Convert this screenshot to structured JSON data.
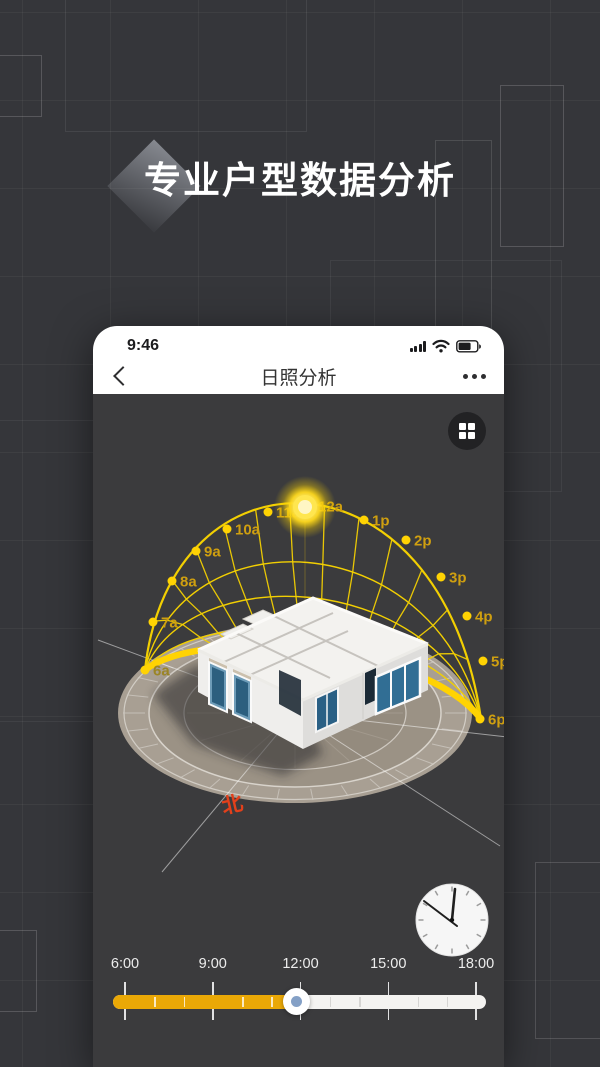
{
  "hero": {
    "title": "专业户型数据分析"
  },
  "phone": {
    "status_bar": {
      "time": "9:46",
      "icons": [
        "signal-bars",
        "wifi",
        "battery"
      ]
    },
    "nav": {
      "title": "日照分析"
    }
  },
  "viewer": {
    "north_label": "北"
  },
  "chart_data": {
    "type": "sun-path-dome",
    "title": "日照分析 sun path over 3D house model",
    "hour_markers": [
      {
        "label": "6a",
        "x": 52,
        "y": 276
      },
      {
        "label": "7a",
        "x": 60,
        "y": 228
      },
      {
        "label": "8a",
        "x": 79,
        "y": 187
      },
      {
        "label": "9a",
        "x": 103,
        "y": 157
      },
      {
        "label": "10a",
        "x": 134,
        "y": 135
      },
      {
        "label": "11a",
        "x": 175,
        "y": 118
      },
      {
        "label": "12a",
        "x": 215,
        "y": 112
      },
      {
        "label": "1p",
        "x": 271,
        "y": 126
      },
      {
        "label": "2p",
        "x": 313,
        "y": 146
      },
      {
        "label": "3p",
        "x": 348,
        "y": 183
      },
      {
        "label": "4p",
        "x": 374,
        "y": 222
      },
      {
        "label": "5p",
        "x": 390,
        "y": 267
      },
      {
        "label": "6p",
        "x": 387,
        "y": 325
      }
    ],
    "sun": {
      "x": 212,
      "y": 113
    }
  },
  "slider": {
    "tick_labels": [
      "6:00",
      "9:00",
      "12:00",
      "15:00",
      "18:00"
    ],
    "selected_fraction": 0.49,
    "minor_tick_hours": [
      7,
      8,
      10,
      11,
      13,
      14,
      16,
      17
    ]
  },
  "colors": {
    "dome_yellow": "#f2cf02",
    "thick_arc": "#ffd303",
    "hour_label": "#cf9f10",
    "hour_label_dim": "#9b8526",
    "slider_fill": "#eaa806",
    "north_red": "#e2401b"
  }
}
